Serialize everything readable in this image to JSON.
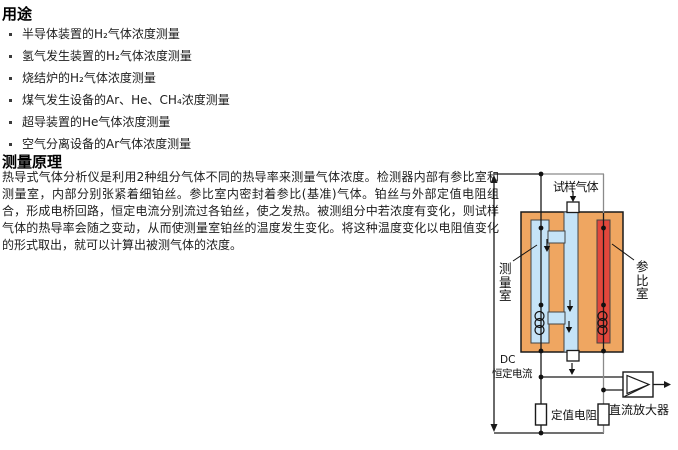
{
  "usage": {
    "heading": "用途",
    "items": [
      "半导体装置的H₂气体浓度测量",
      "氢气发生装置的H₂气体浓度测量",
      "烧结炉的H₂气体浓度测量",
      "煤气发生设备的Ar、He、CH₄浓度测量",
      "超导装置的He气体浓度测量",
      "空气分离设备的Ar气体浓度测量"
    ]
  },
  "principle": {
    "heading": "测量原理",
    "body": "热导式气体分析仪是利用2种组分气体不同的热导率来测量气体浓度。检测器内部有参比室和测量室，内部分别张紧着细铂丝。参比室内密封着参比(基准)气体。铂丝与外部定值电阻组合，形成电桥回路，恒定电流分别流过各铂丝，使之发热。被测组分中若浓度有变化，则试样气体的热导率会随之变动，从而使测量室铂丝的温度发生变化。将这种温度变化以电阻值变化的形式取出，就可以计算出被测气体的浓度。"
  },
  "diagram": {
    "labels": {
      "sample_gas": "试样气体",
      "measurement_chamber": "测量室",
      "reference_chamber": "参比室",
      "dc": "DC",
      "constant_current": "恒定电流",
      "fixed_resistor": "定值电阻",
      "dc_amplifier": "直流放大器"
    },
    "colors": {
      "block": "#EFA661",
      "measurement_channel": "#C5E3F7",
      "reference_channel": "#E2473C",
      "wire": "#1A1A1A",
      "reference_wire": "#8A8A8A"
    }
  }
}
